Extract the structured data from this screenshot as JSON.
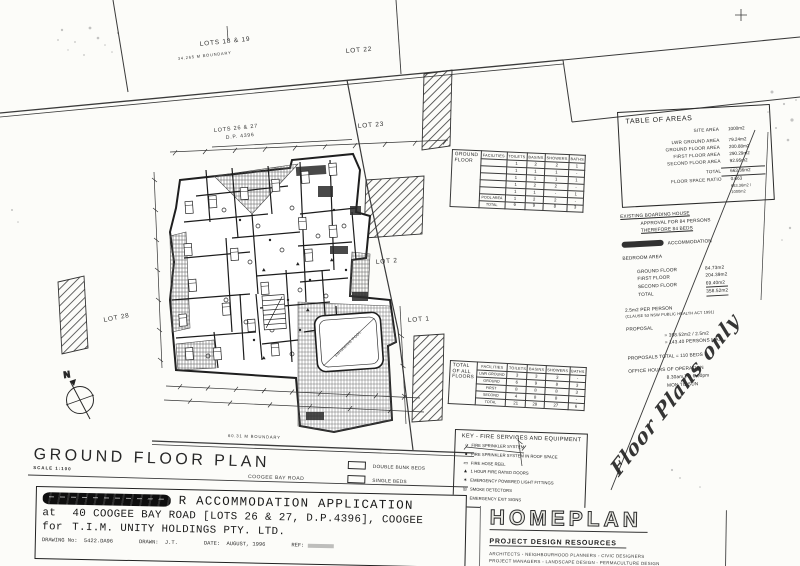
{
  "page": {
    "paper_color": "#fcfcf9",
    "ink_color": "#222222"
  },
  "plan": {
    "heading": "GROUND FLOOR PLAN",
    "scale": "SCALE 1:100",
    "north_label": "N",
    "road_label": "COOGEE BAY ROAD",
    "pool_label": "SWIMMING POOL",
    "lots": {
      "lots_18_19": "LOTS 18 & 19",
      "lot_22": "LOT 22",
      "lot_23": "LOT 23",
      "lots_26_27": "LOTS 26 & 27",
      "dp": "D.P. 4396",
      "lot_28": "LOT 28",
      "lot_2": "LOT 2",
      "lot_1": "LOT 1"
    },
    "boundaries": {
      "top": "34.265 M BOUNDARY",
      "bottom": "60.31 M BOUNDARY"
    }
  },
  "areas_table": {
    "title": "TABLE OF AREAS",
    "rows": [
      {
        "l": "SITE AREA",
        "v": "1000m2",
        "c": "first"
      },
      {
        "l": "LWR GROUND AREA",
        "v": "79.24m2",
        "c": ""
      },
      {
        "l": "GROUND FLOOR AREA",
        "v": "200.88m2",
        "c": ""
      },
      {
        "l": "FIRST FLOOR AREA",
        "v": "290.29m2",
        "c": ""
      },
      {
        "l": "SECOND FLOOR AREA",
        "v": "92.95m2",
        "c": ""
      },
      {
        "l": "TOTAL",
        "v": "663.36m2",
        "c": "tot"
      },
      {
        "l": "FLOOR SPACE RATIO",
        "v": "0.663",
        "c": ""
      },
      {
        "l": "",
        "v": "663.36m2 / 1000m2",
        "c": "sub"
      }
    ]
  },
  "notes": {
    "lines": [
      {
        "t": "EXISTING BOARDING HOUSE",
        "c": "u"
      },
      {
        "t": "APPROVAL FOR 84 PERSONS",
        "c": "ind"
      },
      {
        "t": "THEREFORE 84 BEDS",
        "c": "ind u"
      },
      {
        "t": "ACCOMMODATION",
        "c": "scribble gap"
      },
      {
        "t": "BEDROOM AREA",
        "c": "gap"
      },
      {
        "t": "GROUND FLOOR",
        "v": "84.73m2",
        "c": "kv gap"
      },
      {
        "t": "FIRST FLOOR",
        "v": "204.39m2",
        "c": "kv"
      },
      {
        "t": "SECOND FLOOR",
        "v": "69.40m2",
        "c": "kv"
      },
      {
        "t": "TOTAL",
        "v": "358.52m2",
        "c": "kv tot"
      },
      {
        "t": "2.5m2 PER PERSON",
        "c": "gap"
      },
      {
        "t": "(CLAUSE 53 NSW PUBLIC HEALTH ACT 1991)",
        "c": "small"
      },
      {
        "t": "PROPOSAL",
        "c": "gap"
      },
      {
        "t": "= 358.52m2 / 2.5m2",
        "c": "ind2"
      },
      {
        "t": "= 143.40 PERSONS MAX.",
        "c": "ind2"
      },
      {
        "t": "PROPOSALS TOTAL = 110 BEDS",
        "c": "gap"
      },
      {
        "t": "OFFICE HOURS OF OPERATION",
        "c": "gap"
      },
      {
        "t": "8.30am TO 6.00pm",
        "c": "ind2"
      },
      {
        "t": "MON TO SUN",
        "c": "ind2"
      }
    ]
  },
  "ground_table": {
    "corner": "GROUND FLOOR",
    "headers": [
      "FACILITIES",
      "TOILETS",
      "BASINS",
      "SHOWERS",
      "BATHS"
    ],
    "rows": [
      [
        "",
        "1",
        "2",
        "2",
        "1"
      ],
      [
        "",
        "1",
        "1",
        "1",
        "-"
      ],
      [
        "",
        "1",
        "1",
        "1",
        "1"
      ],
      [
        "",
        "1",
        "2",
        "2",
        "-"
      ],
      [
        "",
        "1",
        "1",
        "-",
        "1"
      ],
      [
        "POOL AREA",
        "1",
        "2",
        "2",
        "-"
      ],
      [
        "TOTAL",
        "6",
        "9",
        "8",
        "3"
      ]
    ]
  },
  "totals_table": {
    "corner": "TOTAL OF ALL FLOORS",
    "headers": [
      "FACILITIES",
      "TOILETS",
      "BASINS",
      "SHOWERS",
      "BATHS"
    ],
    "rows": [
      [
        "LWR GROUND",
        "3",
        "3",
        "3",
        "-"
      ],
      [
        "GROUND",
        "6",
        "9",
        "8",
        "3"
      ],
      [
        "FIRST",
        "8",
        "8",
        "8",
        "3"
      ],
      [
        "SECOND",
        "4",
        "8",
        "8",
        "-"
      ],
      [
        "TOTAL",
        "21",
        "28",
        "27",
        "6"
      ]
    ]
  },
  "key": {
    "title": "KEY - FIRE SERVICES AND EQUIPMENT",
    "items": [
      {
        "sym": "○",
        "label": "FIRE SPRINKLER SYSTEM"
      },
      {
        "sym": "●",
        "label": "FIRE SPRINKLER SYSTEM IN ROOF SPACE"
      },
      {
        "sym": "▭",
        "label": "FIRE HOSE REEL"
      },
      {
        "sym": "▲",
        "label": "1 HOUR FIRE RATED DOORS"
      },
      {
        "sym": "✶",
        "label": "EMERGENCY POWERED LIGHT FITTINGS"
      },
      {
        "sym": "◎",
        "label": "SMOKE DETECTORS"
      },
      {
        "sym": "▣",
        "label": "EMERGENCY EXIT SIGNS"
      }
    ]
  },
  "bed_legend": {
    "items": [
      "DOUBLE BUNK BEDS",
      "SINGLE BEDS"
    ]
  },
  "title_block": {
    "title_prefix": "R",
    "title": "ACCOMMODATION APPLICATION",
    "line2_lead": "at",
    "line2": "40 COOGEE BAY ROAD [LOTS 26 & 27, D.P.4396], COOGEE",
    "line3_lead": "for",
    "line3": "T.I.M. UNITY HOLDINGS PTY. LTD.",
    "drawing_no_label": "DRAWING No:",
    "drawing_no": "5422.DA96",
    "drawn_label": "DRAWN:",
    "drawn": "J.T.",
    "date_label": "DATE:",
    "date": "AUGUST, 1996",
    "ref_label": "REF:"
  },
  "homeplan": {
    "name": "HOMEPLAN",
    "tagline": "PROJECT DESIGN RESOURCES",
    "services1": "ARCHITECTS   ◦   NEIGHBOURHOOD PLANNERS   ◦   CIVIC DESIGNERS",
    "services2": "PROJECT MANAGERS   ◦   LANDSCAPE DESIGN   ◦   PERMACULTURE DESIGN",
    "address": "SUITE 1/7 · KATOOMBA ST · KATOOMBA · PHONE · FAX"
  },
  "handwritten_note": "Floor Plans only"
}
